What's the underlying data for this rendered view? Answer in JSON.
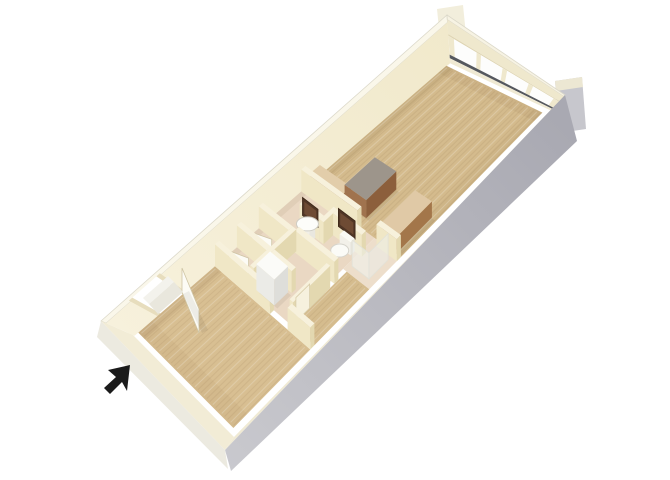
{
  "image": {
    "kind": "3d-floorplan-render",
    "background": "#ffffff"
  },
  "plan": {
    "length": 463,
    "width": 170,
    "top_quad": [
      [
        101,
        321
      ],
      [
        447,
        15
      ],
      [
        565,
        95
      ],
      [
        225,
        450
      ]
    ],
    "floor_quad": [
      [
        133,
        335
      ],
      [
        450,
        61
      ],
      [
        552,
        110
      ],
      [
        234,
        437
      ]
    ]
  },
  "posts": [
    {
      "name": "corner-post-north",
      "points": [
        [
          437,
          9
        ],
        [
          463,
          5
        ],
        [
          467,
          45
        ],
        [
          441,
          49
        ]
      ],
      "fill": "#f2eedc"
    },
    {
      "name": "corner-post-east",
      "points": [
        [
          555,
          81
        ],
        [
          582,
          77
        ],
        [
          586,
          129
        ],
        [
          559,
          133
        ]
      ],
      "fill": "#c7c7cd"
    },
    {
      "name": "corner-post-east-cap",
      "points": [
        [
          555,
          81
        ],
        [
          582,
          77
        ],
        [
          583,
          87
        ],
        [
          556,
          91
        ]
      ],
      "fill": "#ece7d3"
    }
  ],
  "walls3d": [
    {
      "name": "nw-wall",
      "top": [
        [
          101,
          321
        ],
        [
          447,
          15
        ]
      ],
      "floor": [
        [
          133,
          335
        ],
        [
          450,
          61
        ]
      ],
      "bands": [
        {
          "name": "nw-wall-top",
          "t": [
            0,
            1
          ],
          "f": [
            0,
            0.16
          ],
          "fill": "#faf7ea",
          "stroke": "#dcd9ca"
        },
        {
          "name": "nw-wall-face",
          "t": [
            0,
            1
          ],
          "f": [
            0.16,
            1.05
          ],
          "fill": "url(#nwGrad)"
        },
        {
          "name": "entry-door-opening",
          "t": [
            0.078,
            0.156
          ],
          "f": [
            0.1,
            1.05
          ],
          "fill": "#ffffff"
        },
        {
          "name": "entry-door-jamb-left",
          "t": [
            0.072,
            0.082
          ],
          "f": [
            0.1,
            1.05
          ],
          "fill": "#e7ddbd"
        },
        {
          "name": "entry-door-jamb-right",
          "t": [
            0.152,
            0.162
          ],
          "f": [
            0.1,
            1.05
          ],
          "fill": "#e7ddbd"
        }
      ]
    },
    {
      "name": "window-wall",
      "top": [
        [
          447,
          15
        ],
        [
          565,
          95
        ]
      ],
      "floor": [
        [
          450,
          61
        ],
        [
          552,
          110
        ]
      ],
      "bands": [
        {
          "name": "window-wall-top",
          "t": [
            0,
            1
          ],
          "f": [
            0,
            0.1
          ],
          "fill": "#f7f3e3",
          "stroke": "#dcd9ca"
        },
        {
          "name": "window-header",
          "t": [
            0,
            1
          ],
          "f": [
            0.1,
            0.42
          ],
          "fill": "#efe8cd"
        },
        {
          "name": "window-header-shadow",
          "t": [
            0,
            1
          ],
          "f": [
            0.42,
            0.45
          ],
          "fill": "#ded4b2"
        },
        {
          "name": "window-glass",
          "t": [
            0,
            1
          ],
          "f": [
            0.45,
            0.86
          ],
          "fill": "#fdfdfc"
        },
        {
          "name": "window-jamb-left",
          "t": [
            0,
            0.05
          ],
          "f": [
            0.45,
            0.86
          ],
          "fill": "#efe8cd"
        },
        {
          "name": "window-mullion-1",
          "t": [
            0.255,
            0.295
          ],
          "f": [
            0.45,
            0.86
          ],
          "fill": "#efe8cd"
        },
        {
          "name": "window-mullion-2",
          "t": [
            0.49,
            0.53
          ],
          "f": [
            0.45,
            0.86
          ],
          "fill": "#efe8cd"
        },
        {
          "name": "window-mullion-3",
          "t": [
            0.725,
            0.765
          ],
          "f": [
            0.45,
            0.86
          ],
          "fill": "#efe8cd"
        },
        {
          "name": "window-jamb-right",
          "t": [
            0.95,
            1
          ],
          "f": [
            0.45,
            0.86
          ],
          "fill": "#efe8cd"
        },
        {
          "name": "window-sill-track",
          "t": [
            0,
            1
          ],
          "f": [
            0.86,
            0.94
          ],
          "fill": "#55585e"
        },
        {
          "name": "window-baseboard",
          "t": [
            0,
            1
          ],
          "f": [
            0.94,
            1.05
          ],
          "fill": "#efe9d3"
        }
      ]
    }
  ],
  "floors": [
    {
      "name": "bedroom-carpet",
      "rect": [
        6,
        2,
        118,
        162
      ],
      "fill": "#d8bf92",
      "texture": true
    },
    {
      "name": "bath-tile-floor",
      "rect": [
        124,
        2,
        250,
        118
      ],
      "fill": "#ead8c3"
    },
    {
      "name": "shower-tile-floor",
      "rect": [
        204,
        118,
        250,
        162
      ],
      "fill": "#eddecb"
    },
    {
      "name": "hall-carpet",
      "rect": [
        124,
        124,
        204,
        162
      ],
      "fill": "#d5bc8e",
      "texture": true
    },
    {
      "name": "living-carpet",
      "rect": [
        250,
        2,
        456,
        162
      ],
      "fill": "#d4bb8d",
      "texture": true
    }
  ],
  "streaks": {
    "step": 5,
    "dark": "rgba(120,92,52,0.09)",
    "light": "rgba(255,255,255,0.20)"
  },
  "shadows": [
    {
      "name": "floor-shadow-bedroom-nw",
      "rect": [
        6,
        2,
        118,
        13
      ],
      "fill": "rgba(115,88,48,0.10)"
    },
    {
      "name": "floor-shadow-mid-nw",
      "rect": [
        124,
        2,
        250,
        10
      ],
      "fill": "rgba(115,88,48,0.08)"
    },
    {
      "name": "floor-shadow-living-nw",
      "rect": [
        250,
        2,
        456,
        13
      ],
      "fill": "rgba(115,88,48,0.10)"
    },
    {
      "name": "floor-shadow-window-base",
      "rect": [
        444,
        2,
        456,
        162
      ],
      "fill": "rgba(115,88,48,0.07)"
    },
    {
      "name": "floor-shadow-living-se",
      "rect": [
        250,
        148,
        456,
        162
      ],
      "fill": "rgba(115,88,48,0.06)"
    },
    {
      "name": "floor-shadow-bedroom-sw",
      "rect": [
        6,
        2,
        26,
        162
      ],
      "fill": "rgba(115,88,48,0.05)"
    }
  ],
  "items": [
    {
      "type": "box",
      "name": "partition-wall-bedroom-a",
      "rect": [
        118,
        2,
        124,
        94
      ],
      "h": 22,
      "sa": "#f0e7c6",
      "sb": "#e3d8b0",
      "tp": "#f7f1dc"
    },
    {
      "type": "box",
      "name": "partition-wall-bedroom-b",
      "rect": [
        118,
        124,
        124,
        162
      ],
      "h": 22,
      "sa": "#f0e7c6",
      "sb": "#e3d8b0",
      "tp": "#f7f1dc"
    },
    {
      "type": "box",
      "name": "closet-wall-1",
      "rect": [
        150,
        2,
        156,
        52
      ],
      "h": 22,
      "sa": "#f0e7c6",
      "sb": "#e3d8b0",
      "tp": "#f7f1dc"
    },
    {
      "type": "box",
      "name": "closet-wall-2",
      "rect": [
        182,
        2,
        188,
        52
      ],
      "h": 22,
      "sa": "#f0e7c6",
      "sb": "#e3d8b0",
      "tp": "#f7f1dc"
    },
    {
      "type": "box",
      "name": "closet-front-wall",
      "rect": [
        126,
        52,
        188,
        58
      ],
      "h": 22,
      "sa": "#f0e7c6",
      "sb": "#e3d8b0",
      "tp": "#f7f1dc"
    },
    {
      "type": "box",
      "name": "niche-wall",
      "rect": [
        150,
        58,
        156,
        94
      ],
      "h": 22,
      "sa": "#f0e7c6",
      "sb": "#e3d8b0",
      "tp": "#f7f1dc"
    },
    {
      "type": "box",
      "name": "bath-west-wall",
      "rect": [
        186,
        58,
        192,
        124
      ],
      "h": 22,
      "sa": "#f0e7c6",
      "sb": "#e3d8b0",
      "tp": "#f7f1dc"
    },
    {
      "type": "box",
      "name": "closet-slider-wall",
      "rect": [
        126,
        118,
        180,
        124
      ],
      "h": 22,
      "sa": "#f0e7c6",
      "sb": "#e3d8b0",
      "tp": "#f7f1dc"
    },
    {
      "type": "box",
      "name": "vanity-wall",
      "rect": [
        212,
        36,
        218,
        70
      ],
      "h": 22,
      "sa": "#f0e7c6",
      "sb": "#e3d8b0",
      "tp": "#f7f1dc"
    },
    {
      "type": "box",
      "name": "bath-mid-wall",
      "rect": [
        212,
        70,
        232,
        76
      ],
      "h": 22,
      "sa": "#f0e7c6",
      "sb": "#e3d8b0",
      "tp": "#f7f1dc"
    },
    {
      "type": "box",
      "name": "toilet-wall",
      "rect": [
        226,
        76,
        232,
        124
      ],
      "h": 22,
      "sa": "#f0e7c6",
      "sb": "#e3d8b0",
      "tp": "#f7f1dc"
    },
    {
      "type": "box",
      "name": "kitchen-wall-a",
      "rect": [
        244,
        2,
        250,
        96
      ],
      "h": 22,
      "sa": "#f0e7c6",
      "sb": "#e3d8b0",
      "tp": "#f7f1dc"
    },
    {
      "type": "box",
      "name": "kitchen-wall-b",
      "rect": [
        244,
        128,
        250,
        162
      ],
      "h": 22,
      "sa": "#f0e7c6",
      "sb": "#e3d8b0",
      "tp": "#f7f1dc"
    },
    {
      "type": "box",
      "name": "appliance",
      "rect": [
        128,
        60,
        148,
        90
      ],
      "h": 26,
      "sa": "#ebebe7",
      "sb": "#dededa",
      "tp": "#fbfbf8",
      "shadow": true
    },
    {
      "type": "box",
      "name": "kitchen-counter",
      "rect": [
        252,
        8,
        266,
        60
      ],
      "h": 16,
      "sa": "#a87c52",
      "sb": "#96683f",
      "tp": "#e2cdaa",
      "shadow": true
    },
    {
      "type": "box",
      "name": "kitchen-island",
      "rect": [
        262,
        54,
        306,
        90
      ],
      "h": 18,
      "sa": "#a0734e",
      "sb": "#8c5f3c",
      "tp": "#9d958b",
      "shadow": true
    },
    {
      "type": "box",
      "name": "counter-along-se-wall",
      "rect": [
        254,
        126,
        302,
        154
      ],
      "h": 16,
      "sa": "#b68a5e",
      "sb": "#a3764a",
      "tp": "#e0c9a6",
      "shadow": true
    },
    {
      "type": "box",
      "name": "toilet-tank",
      "rect": [
        220,
        94,
        226,
        112
      ],
      "h": 13,
      "sa": "#f2f0e9",
      "sb": "#e6e4dc",
      "tp": "#fafaf5"
    },
    {
      "type": "box",
      "name": "sink-pedestal",
      "rect": [
        204,
        48,
        212,
        62
      ],
      "h": 12,
      "sa": "#f1efe8",
      "sb": "#e9e7df",
      "tp": "#f8f8f3"
    },
    {
      "type": "panel",
      "name": "vanity-mirror",
      "from": [
        211,
        42
      ],
      "to": [
        211,
        68
      ],
      "lift": 14,
      "h": 18,
      "fill": "#503626",
      "stroke": "#3c2718"
    },
    {
      "type": "panel",
      "name": "vanity-mirror-glass",
      "from": [
        211,
        45
      ],
      "to": [
        211,
        65
      ],
      "lift": 17,
      "h": 12,
      "fill": "#6e4b34"
    },
    {
      "type": "panel",
      "name": "toilet-mirror",
      "from": [
        225,
        86
      ],
      "to": [
        225,
        114
      ],
      "lift": 14,
      "h": 18,
      "fill": "#503626",
      "stroke": "#3c2718"
    },
    {
      "type": "panel",
      "name": "toilet-mirror-glass",
      "from": [
        225,
        89
      ],
      "to": [
        225,
        111
      ],
      "lift": 17,
      "h": 12,
      "fill": "#6e4b34"
    },
    {
      "type": "panel",
      "name": "closet-slider-door-1",
      "from": [
        130,
        124
      ],
      "to": [
        150,
        124
      ],
      "h": 24,
      "fill": "#f6f1de",
      "stroke": "#d8cdaa"
    },
    {
      "type": "panel",
      "name": "closet-slider-door-2",
      "from": [
        152,
        124
      ],
      "to": [
        172,
        124
      ],
      "h": 24,
      "fill": "#f1ebd6",
      "stroke": "#d8cdaa"
    },
    {
      "type": "panel",
      "name": "closet-cell-door-1",
      "from": [
        126,
        16
      ],
      "to": [
        134,
        40
      ],
      "h": 18,
      "fill": "#fcfbf5",
      "stroke": "#cfc5a5"
    },
    {
      "type": "panel",
      "name": "closet-cell-door-2",
      "from": [
        158,
        18
      ],
      "to": [
        166,
        42
      ],
      "h": 18,
      "fill": "#fcfbf5",
      "stroke": "#cfc5a5"
    },
    {
      "type": "panel",
      "name": "shower-glass-side",
      "from": [
        212,
        124
      ],
      "to": [
        212,
        152
      ],
      "h": 26,
      "fill": "rgba(242,245,244,0.50)",
      "stroke": "#e2e2d8"
    },
    {
      "type": "panel",
      "name": "shower-glass-front",
      "from": [
        212,
        152
      ],
      "to": [
        240,
        152
      ],
      "h": 26,
      "fill": "rgba(236,240,240,0.45)",
      "stroke": "#e2e2d8"
    },
    {
      "type": "ellipse",
      "name": "sink-basin",
      "c": [
        206,
        56
      ],
      "rx": 11,
      "ry": 7,
      "lift": 15,
      "fill": "#fdfdfa",
      "stroke": "#cfcdc4"
    },
    {
      "type": "ellipse",
      "name": "toilet-bowl",
      "c": [
        213,
        102
      ],
      "rx": 9,
      "ry": 6.5,
      "lift": 5,
      "fill": "#fbfbf7",
      "stroke": "#d6d4cc"
    },
    {
      "type": "ellipse",
      "name": "toilet-lid",
      "c": [
        215,
        102
      ],
      "rx": 6.5,
      "ry": 4.5,
      "lift": 7,
      "fill": "#f1efe8",
      "stroke": "none"
    },
    {
      "type": "poly",
      "name": "entry-door-floor-shadow",
      "points": [
        [
          183,
          294
        ],
        [
          202,
          333
        ],
        [
          208,
          330
        ],
        [
          189,
          291
        ]
      ],
      "fill": "rgba(0,0,0,0.06)"
    },
    {
      "type": "poly",
      "name": "entry-door-leaf",
      "points": [
        [
          182,
          292
        ],
        [
          199,
          333
        ],
        [
          199,
          309
        ],
        [
          182,
          268
        ]
      ],
      "fill": "#fcfbf5",
      "stroke": "#cfc5a5"
    }
  ],
  "near_walls": [
    {
      "name": "se-wall-top",
      "points": [
        [
          225,
          450
        ],
        [
          565,
          95
        ],
        [
          552,
          110
        ],
        [
          234,
          437
        ]
      ],
      "fill": "#f0ead4"
    },
    {
      "name": "se-wall-exterior",
      "points": [
        [
          225,
          450
        ],
        [
          565,
          95
        ],
        [
          577,
          141
        ],
        [
          231,
          471
        ]
      ],
      "fill": "url(#seGrad)"
    },
    {
      "name": "sw-wall-top",
      "points": [
        [
          101,
          321
        ],
        [
          225,
          450
        ],
        [
          234,
          437
        ],
        [
          133,
          335
        ]
      ],
      "fill": "#f2ecd6"
    },
    {
      "name": "sw-wall-exterior",
      "points": [
        [
          101,
          321
        ],
        [
          225,
          450
        ],
        [
          228,
          469
        ],
        [
          97,
          337
        ]
      ],
      "fill": "#eceae0"
    },
    {
      "name": "entry-stoop",
      "points": [
        [
          158,
          314
        ],
        [
          183,
          292
        ],
        [
          174,
          282
        ],
        [
          149,
          304
        ]
      ],
      "fill": "#e9e7dd"
    },
    {
      "name": "entry-stoop-step",
      "points": [
        [
          149,
          304
        ],
        [
          174,
          282
        ],
        [
          168,
          276
        ],
        [
          143,
          298
        ]
      ],
      "fill": "#f3f2ec"
    }
  ],
  "cursor": {
    "name": "cursor-arrow",
    "points": [
      [
        130,
        365
      ],
      [
        108,
        370
      ],
      [
        116,
        377
      ],
      [
        104,
        388
      ],
      [
        110,
        394
      ],
      [
        122,
        382
      ],
      [
        127,
        391
      ]
    ],
    "fill": "#1b1b1b"
  }
}
